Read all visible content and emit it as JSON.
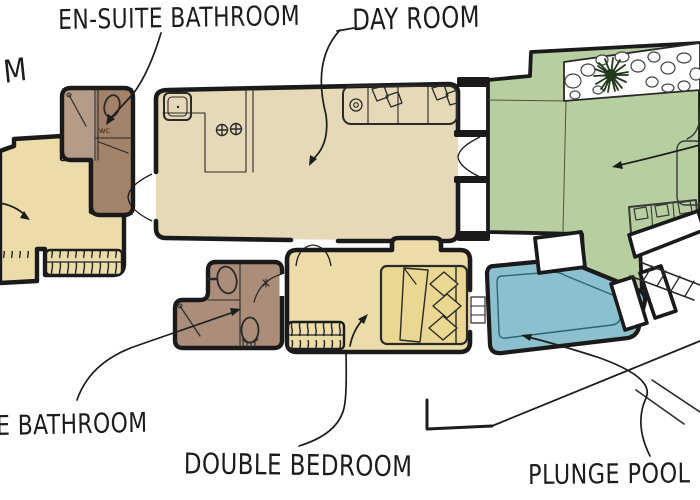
{
  "plan": {
    "labels": {
      "fragment": {
        "text": "M"
      },
      "en_suite": {
        "text": "EN-SUITE BATHROOM"
      },
      "day_room": {
        "text": "DAY ROOM"
      },
      "bathroom": {
        "text": "E BATHROOM"
      },
      "double_bedroom": {
        "text": "DOUBLE BEDROOM"
      },
      "plunge_pool": {
        "text": "PLUNGE POOL"
      },
      "wc": {
        "text": "WC"
      }
    },
    "colors": {
      "ink": "#1c1c1c",
      "wall": "#1a1a1a",
      "room_cream": "#ecdcaa",
      "room_beige": "#e6d9b8",
      "bed_cream": "#ead792",
      "bathroom_main": "#ab8d79",
      "ensuite_light": "#b59c89",
      "ensuite_dark": "#a28269",
      "garden_green": "#b7cfa0",
      "tree_green": "#22391d",
      "pool_blue": "#8cc0cf",
      "pool_edge": "#2e6573",
      "paper": "#ffffff"
    }
  }
}
